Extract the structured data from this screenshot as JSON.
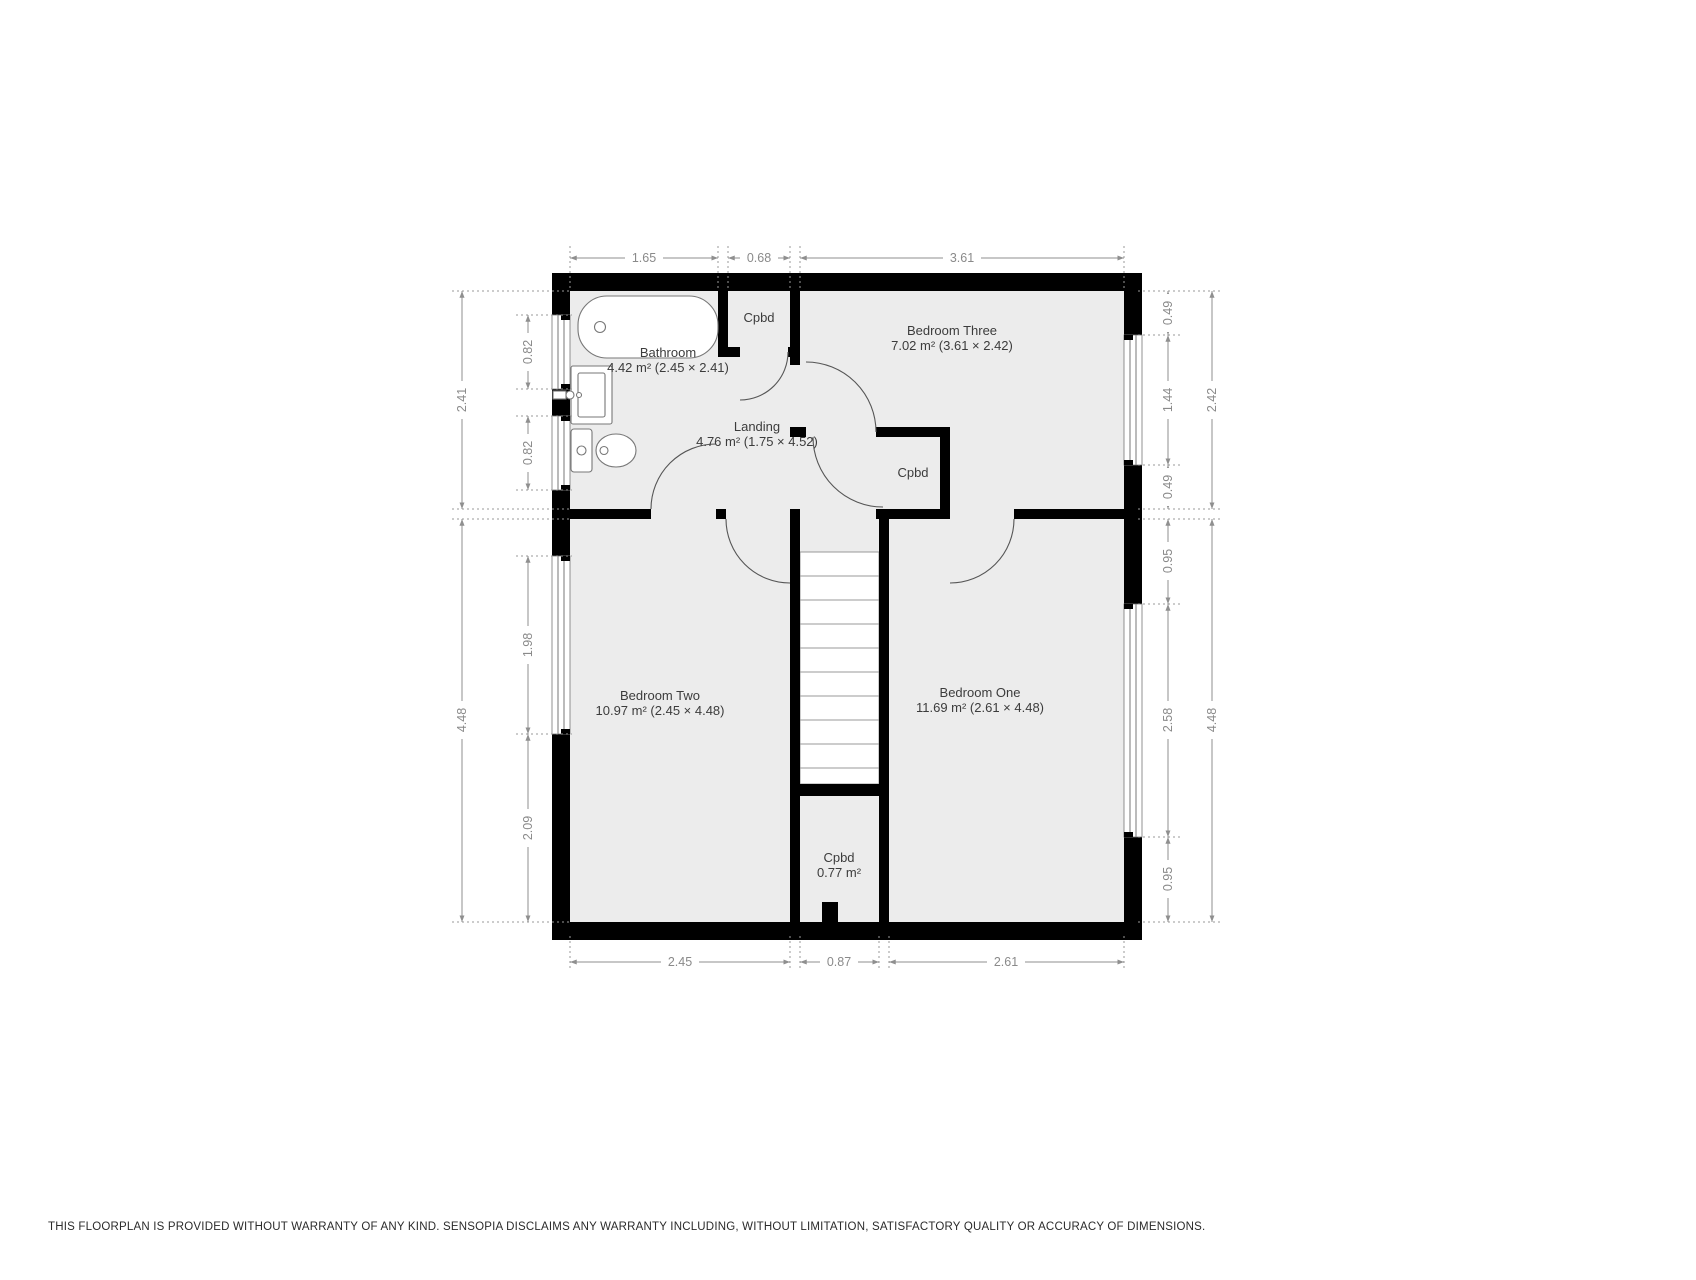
{
  "floorplan": {
    "rooms": {
      "bathroom": {
        "name": "Bathroom",
        "area": "4.42 m² (2.45 × 2.41)"
      },
      "cpbd_top": {
        "name": "Cpbd"
      },
      "bedroom_three": {
        "name": "Bedroom Three",
        "area": "7.02 m² (3.61 × 2.42)"
      },
      "landing": {
        "name": "Landing",
        "area": "4.76 m² (1.75 × 4.52)"
      },
      "cpbd_landing": {
        "name": "Cpbd"
      },
      "bedroom_two": {
        "name": "Bedroom Two",
        "area": "10.97 m² (2.45 × 4.48)"
      },
      "bedroom_one": {
        "name": "Bedroom One",
        "area": "11.69 m² (2.61 × 4.48)"
      },
      "cpbd_bottom": {
        "name": "Cpbd",
        "area": "0.77 m²"
      }
    },
    "dims": {
      "top": [
        "1.65",
        "0.68",
        "3.61"
      ],
      "bottom": [
        "2.45",
        "0.87",
        "2.61"
      ],
      "left_outer": [
        "2.41",
        "4.48"
      ],
      "left_inner": [
        "0.82",
        "0.82",
        "1.98",
        "2.09"
      ],
      "right_inner": [
        "0.49",
        "1.44",
        "0.49",
        "0.95",
        "2.58",
        "0.95"
      ],
      "right_outer": [
        "2.42",
        "4.48"
      ]
    },
    "colors": {
      "wall": "#000000",
      "room_fill": "#ececec",
      "dim_line": "#8f8f8f",
      "dim_text": "#8a8a8a",
      "room_text": "#3c3c3c"
    }
  },
  "footer": {
    "disclaimer": "THIS FLOORPLAN IS PROVIDED WITHOUT WARRANTY OF ANY KIND. SENSOPIA DISCLAIMS ANY WARRANTY INCLUDING, WITHOUT LIMITATION, SATISFACTORY QUALITY OR ACCURACY OF DIMENSIONS."
  }
}
